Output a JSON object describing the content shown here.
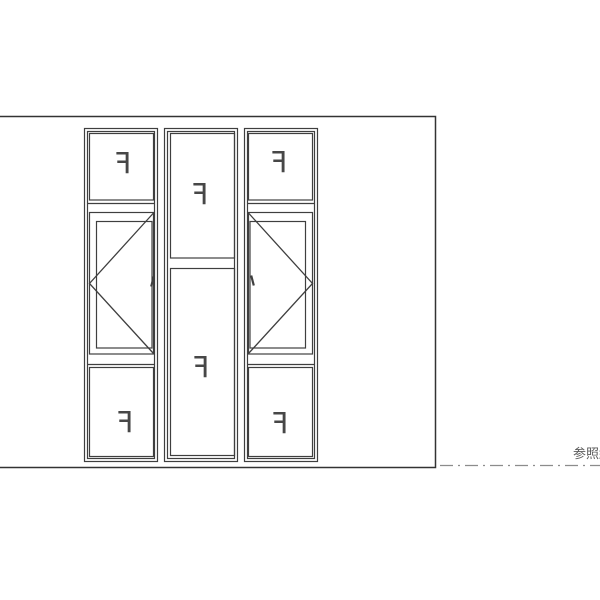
{
  "drawing": {
    "title": "window-elevation-drawing",
    "panels": [
      {
        "position": "left-top-fixed",
        "label": "F"
      },
      {
        "position": "center-top-fixed",
        "label": "F"
      },
      {
        "position": "right-top-fixed",
        "label": "F"
      },
      {
        "position": "left-bottom-fixed",
        "label": "F"
      },
      {
        "position": "center-bottom-fixed",
        "label": "F"
      },
      {
        "position": "right-bottom-fixed",
        "label": "F"
      }
    ],
    "annotation": {
      "label": "参照線"
    },
    "colors": {
      "window_line": "#3f3f3f",
      "wall_line": "#333333",
      "reference_line": "#8c8c8c",
      "label_text": "#474747",
      "annotation_text": "#5a5a5a",
      "background": "#ffffff"
    }
  }
}
